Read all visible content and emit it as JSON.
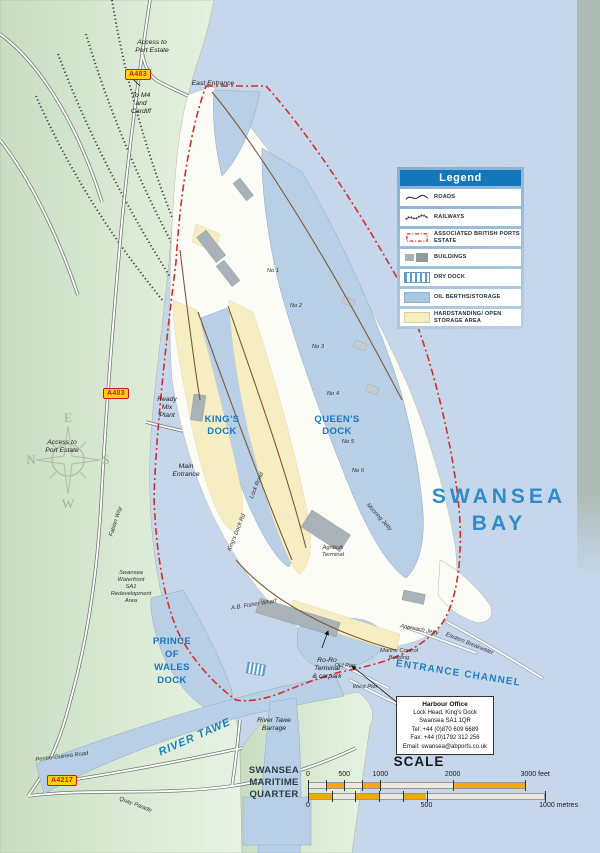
{
  "legend": {
    "title": "Legend",
    "items": [
      {
        "label": "ROADS",
        "swatch": "road"
      },
      {
        "label": "RAILWAYS",
        "swatch": "railway"
      },
      {
        "label": "ASSOCIATED BRITISH PORTS ESTATE",
        "swatch": "estate"
      },
      {
        "label": "BUILDINGS",
        "swatch": "buildings"
      },
      {
        "label": "DRY DOCK",
        "swatch": "drydock"
      },
      {
        "label": "OIL BERTHS/STORAGE",
        "swatch": "oilberth"
      },
      {
        "label": "HARDSTANDING/ OPEN STORAGE AREA",
        "swatch": "hardstanding"
      }
    ]
  },
  "info_box": {
    "lines": [
      "Harbour Office",
      "Lock Head, King's Dock",
      "Swansea SA1 1QR",
      "Tel: +44 (0)870 609 6689",
      "Fax: +44 (0)1792 312 256",
      "Email: swansea@abports.co.uk"
    ]
  },
  "scale": {
    "title": "SCALE",
    "feet": {
      "unit": "feet",
      "max": 3000,
      "ticks": [
        0,
        500,
        1000,
        2000,
        3000
      ],
      "orange": [
        [
          250,
          500
        ],
        [
          750,
          1000
        ],
        [
          2000,
          3000
        ]
      ]
    },
    "metres": {
      "unit": "metres",
      "max": 1000,
      "ticks": [
        0,
        500,
        1000
      ],
      "orange": [
        [
          0,
          100
        ],
        [
          200,
          300
        ],
        [
          400,
          500
        ]
      ]
    }
  },
  "compass": {
    "n": "N",
    "e": "E",
    "s": "S",
    "w": "W"
  },
  "road_badges": {
    "a483": "A483",
    "a4217": "A4217"
  },
  "colors": {
    "sea": "#c7d7eb",
    "dock_water": "#b9cfe6",
    "land": "#d8e8d2",
    "hardstanding": "#f6eec2",
    "building": "#a9b2b8",
    "estate_boundary": "#d03028",
    "legend_header": "#1278bb",
    "label_blue": "#1878be",
    "badge_yellow": "#ffd200",
    "badge_red": "#c81e1e",
    "scale_orange": "#f2a90f"
  },
  "map": {
    "labels": [
      {
        "name": "access-to-port-estate-north",
        "cls": "c-small",
        "x": 152,
        "y": 44,
        "lh": 8,
        "lines": [
          "Access to",
          "Port Estate"
        ]
      },
      {
        "name": "to-m4-and-cardiff",
        "cls": "c-small",
        "x": 141,
        "y": 97,
        "lh": 8,
        "lines": [
          "To M4",
          "and",
          "Cardiff"
        ]
      },
      {
        "name": "east-entrance",
        "cls": "c-small",
        "x": 213,
        "y": 85,
        "lh": 8,
        "lines": [
          "East Entrance"
        ]
      },
      {
        "name": "access-to-port-estate-west",
        "cls": "c-small",
        "x": 62,
        "y": 444,
        "lh": 8,
        "lines": [
          "Access to",
          "Port Estate"
        ]
      },
      {
        "name": "ready-mix-plant",
        "cls": "c-small",
        "x": 167,
        "y": 401,
        "lh": 8,
        "lines": [
          "Ready",
          "Mix",
          "Plant"
        ]
      },
      {
        "name": "main-entrance",
        "cls": "c-small",
        "x": 186,
        "y": 468,
        "lh": 8,
        "lines": [
          "Main",
          "Entrance"
        ]
      },
      {
        "name": "kings-dock",
        "cls": "c-dock",
        "x": 222,
        "y": 422,
        "lh": 12,
        "lines": [
          "KING'S",
          "DOCK"
        ]
      },
      {
        "name": "queens-dock",
        "cls": "c-dock",
        "x": 337,
        "y": 422,
        "lh": 12,
        "lines": [
          "QUEEN'S",
          "DOCK"
        ]
      },
      {
        "name": "prince-of-wales-dock",
        "cls": "c-dock",
        "x": 172,
        "y": 644,
        "lh": 13,
        "lines": [
          "PRINCE",
          "OF",
          "WALES",
          "DOCK"
        ]
      },
      {
        "name": "river-tawe",
        "cls": "c-river",
        "x": 196,
        "y": 740,
        "rot": -24,
        "lines": [
          "RIVER TAWE"
        ]
      },
      {
        "name": "swansea-bay",
        "cls": "c-bay",
        "x": 499,
        "y": 503,
        "lh": 27,
        "lines": [
          "SWANSEA",
          "BAY"
        ]
      },
      {
        "name": "entrance-channel",
        "cls": "c-channel",
        "x": 458,
        "y": 676,
        "rot": 9,
        "lines": [
          "ENTRANCE CHANNEL"
        ]
      },
      {
        "name": "swansea-maritime-quarter",
        "cls": "c-dark",
        "x": 274,
        "y": 773,
        "lh": 12,
        "lines": [
          "SWANSEA",
          "MARITIME",
          "QUARTER"
        ]
      },
      {
        "name": "fabian-way",
        "cls": "c-tiny",
        "x": 117,
        "y": 522,
        "rot": -72,
        "lines": [
          "Fabian Way"
        ]
      },
      {
        "name": "sa1-redevelopment-area",
        "cls": "c-tiny",
        "x": 131,
        "y": 574,
        "lh": 7,
        "lines": [
          "Swansea",
          "Waterfront",
          "SA1",
          "Redevelopment",
          "Area"
        ]
      },
      {
        "name": "pentre-guinea-road",
        "cls": "c-tiny",
        "x": 62,
        "y": 758,
        "rot": -7,
        "lines": [
          "Pentre-Guinea Road"
        ]
      },
      {
        "name": "quay-parade",
        "cls": "c-tiny",
        "x": 135,
        "y": 806,
        "rot": 21,
        "lines": [
          "Quay Parade"
        ]
      },
      {
        "name": "river-tawe-barrage",
        "cls": "c-small",
        "x": 274,
        "y": 722,
        "lh": 8,
        "lines": [
          "River Tawe",
          "Barrage"
        ]
      },
      {
        "name": "ab-fisher-wharf",
        "cls": "c-tiny",
        "x": 254,
        "y": 606,
        "rot": -9,
        "lines": [
          "A.B. Fisher Wharf"
        ]
      },
      {
        "name": "approach-jetty",
        "cls": "c-tiny",
        "x": 419,
        "y": 631,
        "rot": 11,
        "lines": [
          "Approach Jetty"
        ]
      },
      {
        "name": "eastern-breakwater",
        "cls": "c-tiny",
        "x": 469,
        "y": 645,
        "rot": 22,
        "lines": [
          "Eastern Breakwater"
        ]
      },
      {
        "name": "marine-control-building",
        "cls": "c-tiny",
        "x": 399,
        "y": 652,
        "lh": 7,
        "lines": [
          "Marine Control",
          "Building"
        ]
      },
      {
        "name": "old-pier",
        "cls": "c-tiny",
        "x": 345,
        "y": 667,
        "lines": [
          "Old Pier"
        ]
      },
      {
        "name": "west-pier",
        "cls": "c-tiny",
        "x": 365,
        "y": 688,
        "lines": [
          "West Pier"
        ]
      },
      {
        "name": "ro-ro-terminal",
        "cls": "c-small",
        "x": 327,
        "y": 662,
        "lh": 8,
        "lines": [
          "Ro-Ro",
          "Terminal",
          "& carpark"
        ]
      },
      {
        "name": "berth-no-1",
        "cls": "c-tiny",
        "x": 273,
        "y": 272,
        "lines": [
          "No 1"
        ]
      },
      {
        "name": "berth-no-2",
        "cls": "c-tiny",
        "x": 296,
        "y": 307,
        "lines": [
          "No 2"
        ]
      },
      {
        "name": "berth-no-3",
        "cls": "c-tiny",
        "x": 318,
        "y": 348,
        "lines": [
          "No 3"
        ]
      },
      {
        "name": "berth-no-4",
        "cls": "c-tiny",
        "x": 333,
        "y": 395,
        "lines": [
          "No 4"
        ]
      },
      {
        "name": "berth-no-5",
        "cls": "c-tiny",
        "x": 348,
        "y": 443,
        "lines": [
          "No 5"
        ]
      },
      {
        "name": "berth-no-6",
        "cls": "c-tiny",
        "x": 358,
        "y": 472,
        "lines": [
          "No 6"
        ]
      },
      {
        "name": "lock-road",
        "cls": "c-tiny",
        "x": 258,
        "y": 486,
        "rot": -68,
        "lines": [
          "Lock Road"
        ]
      },
      {
        "name": "kings-dock-road",
        "cls": "c-tiny",
        "x": 238,
        "y": 533,
        "rot": -68,
        "lines": [
          "King's Dock Rd"
        ]
      },
      {
        "name": "agribulk-terminal",
        "cls": "c-tiny",
        "x": 333,
        "y": 549,
        "lh": 7,
        "lines": [
          "Agribulk",
          "Terminal"
        ]
      },
      {
        "name": "mooring-jetty",
        "cls": "c-tiny",
        "x": 378,
        "y": 518,
        "rot": 48,
        "lines": [
          "Mooring Jetty"
        ]
      }
    ]
  }
}
